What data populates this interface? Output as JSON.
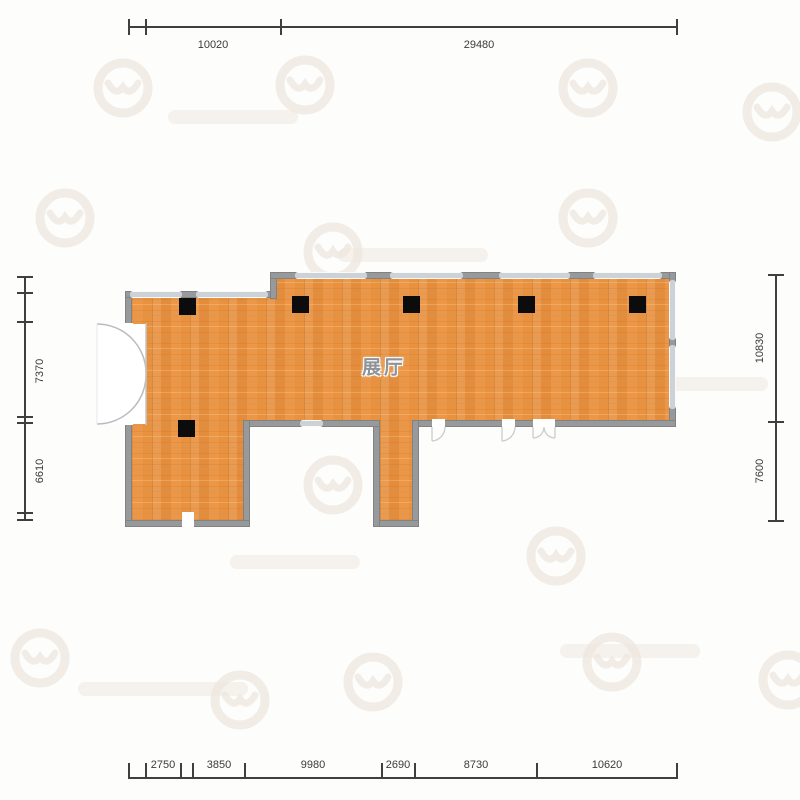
{
  "plan": {
    "room_label": "展厅",
    "dimensions": {
      "top": [
        "10020",
        "29480"
      ],
      "bottom": [
        "2750",
        "3850",
        "9980",
        "2690",
        "8730",
        "10620"
      ],
      "left": [
        "7370",
        "6610"
      ],
      "right": [
        "10830",
        "7600"
      ]
    },
    "colors": {
      "floor_orange": "#e8913f",
      "wall_gray": "#98999b",
      "column_black": "#0c0c0c",
      "dimension_line": "#3f3f3f",
      "window_light": "#cdd2d6"
    }
  }
}
